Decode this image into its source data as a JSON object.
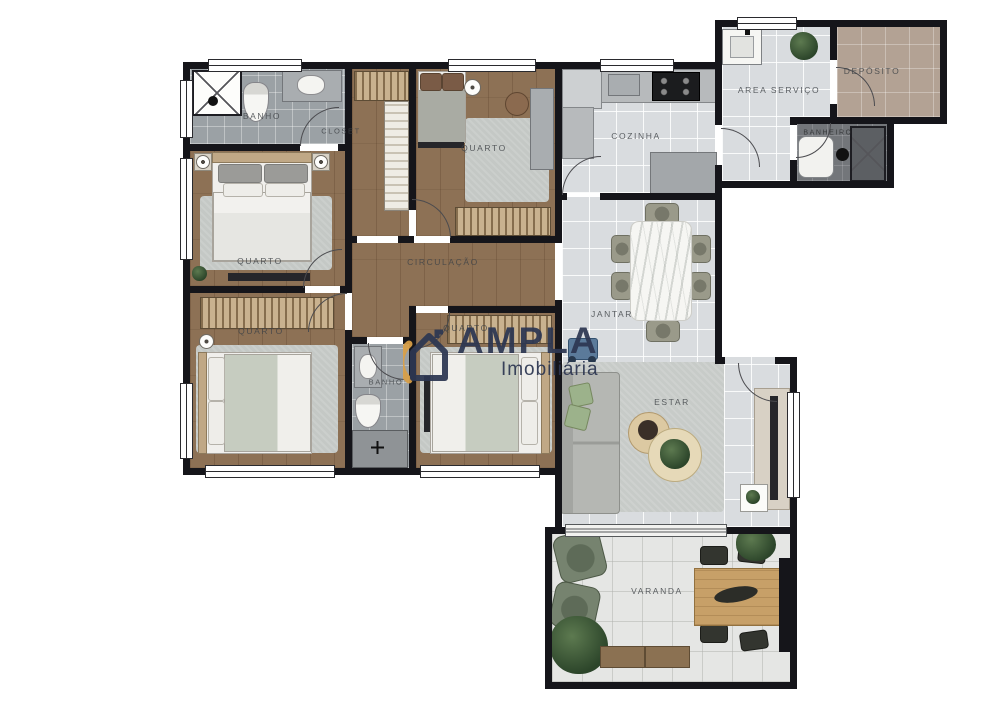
{
  "plan": {
    "rooms": {
      "banho_suite": {
        "label": "BANHO"
      },
      "quarto_suite": {
        "label": "QUARTO"
      },
      "closet": {
        "label": "CLOSET"
      },
      "quarto_2": {
        "label": "QUARTO"
      },
      "circulacao": {
        "label": "CIRCULAÇÃO"
      },
      "quarto_3": {
        "label": "QUARTO"
      },
      "banho_social": {
        "label": "BANHO"
      },
      "quarto_4": {
        "label": "QUARTO"
      },
      "cozinha": {
        "label": "COZINHA"
      },
      "area_servico": {
        "label": "AREA SERVIÇO"
      },
      "deposito": {
        "label": "DEPÓSITO"
      },
      "banheiro_servico": {
        "label": "BANHEIRO"
      },
      "jantar": {
        "label": "JANTAR"
      },
      "estar": {
        "label": "ESTAR"
      },
      "varanda": {
        "label": "VARANDA"
      }
    },
    "watermark": {
      "name": "AMPLA",
      "tagline": "Imobiliária"
    },
    "palette": {
      "wall": "#15151a",
      "wood": "#8d7155",
      "tile_gray": "#9ba1a5",
      "tile_light": "#d9dcdf",
      "tile_varanda": "#e5e6e4",
      "deposito": "#b3a294",
      "dark_floor": "#73767a",
      "rug": "#c4c8c5",
      "wardrobe_light": "#c9b28f",
      "wardrobe_dark": "#866e4e",
      "brand_navy": "#2d3752",
      "brand_gold": "#d99f47",
      "sofa": "#b5b7b3",
      "green": "#53704a",
      "sage": "#9cb28b",
      "wood_furniture": "#c7a068",
      "marble": "#f6f6f3",
      "label": "#3f4347"
    }
  }
}
